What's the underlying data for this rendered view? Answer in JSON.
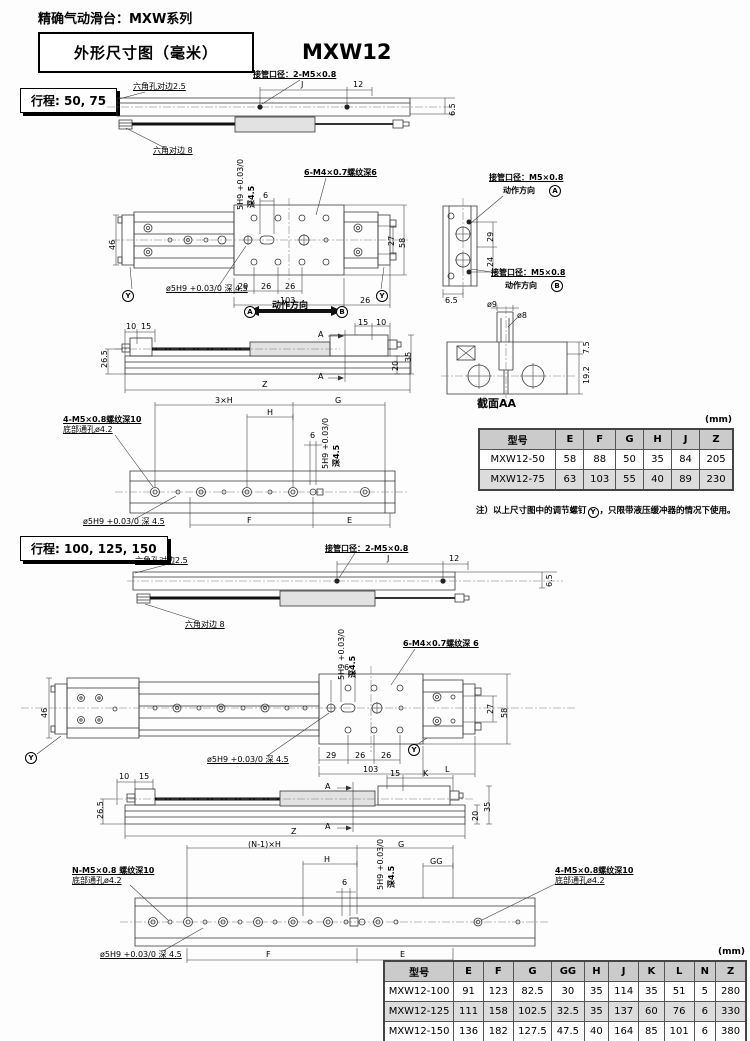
{
  "page": {
    "title": "精确气动滑台：MXW系列",
    "dim_box": "外形尺寸图（毫米）",
    "model": "MXW12"
  },
  "s1": {
    "stroke_label": "行程: 50, 75",
    "sv": {
      "hex_hole": "六角孔对边2.5",
      "port": "接管口径：2-M5×0.8",
      "j": "J",
      "d12": "12",
      "d65": "6.5",
      "hex_flat": "六角对边 8"
    },
    "tv": {
      "pin_tol": "5H9 +0.03/0",
      "pin_depth": "深4.5",
      "d6": "6",
      "thread": "6-M4×0.7螺纹深6",
      "d46": "46",
      "d27": "27",
      "d58": "58",
      "pin_hole": "ø5H9 +0.03/0 深 4.5",
      "d29": "29",
      "d26a": "26",
      "d26b": "26",
      "d103": "103",
      "d26c": "26",
      "y": "Y",
      "dir_label": "动作方向",
      "a": "A",
      "b": "B"
    },
    "fv": {
      "d10": "10",
      "d15": "15",
      "a": "A",
      "d15r": "15",
      "d10r": "10",
      "d20": "20",
      "d35": "35",
      "d265": "26.5",
      "z": "Z"
    },
    "bv": {
      "d3xh": "3×H",
      "g": "G",
      "h": "H",
      "d6": "6",
      "pin_tol": "5H9 +0.03/0",
      "pin_depth": "深4.5",
      "thread1": "4-M5×0.8螺纹深10",
      "thread2": "底部通孔ø4.2",
      "pin_hole": "ø5H9 +0.03/0 深 4.5",
      "f": "F",
      "e": "E"
    },
    "ev": {
      "port_a": "接管口径：M5×0.8",
      "dir_a": "动作方向",
      "a": "A",
      "d29": "29",
      "d24": "24",
      "port_b": "接管口径：M5×0.8",
      "dir_b": "动作方向",
      "b": "B",
      "d65": "6.5"
    },
    "aa": {
      "d9": "ø9",
      "d8": "ø8",
      "d75": "7.5",
      "d192": "19.2",
      "label": "截面AA"
    },
    "table": {
      "unit": "(mm)",
      "headers": [
        "型号",
        "E",
        "F",
        "G",
        "H",
        "J",
        "Z"
      ],
      "rows": [
        [
          "MXW12-50",
          "58",
          "88",
          "50",
          "35",
          "84",
          "205"
        ],
        [
          "MXW12-75",
          "63",
          "103",
          "55",
          "40",
          "89",
          "230"
        ]
      ],
      "note_pre": "注）以上尺寸图中的调节螺钉",
      "note_y": "Y",
      "note_post": "，只限带液压缓冲器的情况下使用。"
    }
  },
  "s2": {
    "stroke_label": "行程: 100, 125, 150",
    "sv": {
      "hex_hole": "六角孔对边2.5",
      "port": "接管口径：2-M5×0.8",
      "j": "J",
      "d12": "12",
      "d65": "6.5",
      "hex_flat": "六角对边 8"
    },
    "tv": {
      "pin_tol": "5H9 +0.03/0",
      "pin_depth": "深4.5",
      "d6": "6",
      "thread": "6-M4×0.7螺纹深 6",
      "d46": "46",
      "d27": "27",
      "d58": "58",
      "pin_hole": "ø5H9 +0.03/0 深 4.5",
      "d29": "29",
      "d26a": "26",
      "d26b": "26",
      "d103": "103",
      "l": "L",
      "y": "Y"
    },
    "fv": {
      "d10": "10",
      "d15": "15",
      "a": "A",
      "d15r": "15",
      "k": "K",
      "d20": "20",
      "d35": "35",
      "d265": "26.5",
      "z": "Z"
    },
    "bv": {
      "n1xh": "(N-1)×H",
      "g": "G",
      "h": "H",
      "d6": "6",
      "pin_tol": "5H9 +0.03/0",
      "pin_depth": "深4.5",
      "gg": "GG",
      "thread_n1": "N-M5×0.8 螺纹深10",
      "thread_n2": "底部通孔ø4.2",
      "thread_41": "4-M5×0.8螺纹深10",
      "thread_42": "底部通孔ø4.2",
      "pin_hole": "ø5H9 +0.03/0 深 4.5",
      "f": "F",
      "e": "E"
    },
    "table": {
      "unit": "(mm)",
      "headers": [
        "型号",
        "E",
        "F",
        "G",
        "GG",
        "H",
        "J",
        "K",
        "L",
        "N",
        "Z"
      ],
      "rows": [
        [
          "MXW12-100",
          "91",
          "123",
          "82.5",
          "30",
          "35",
          "114",
          "35",
          "51",
          "5",
          "280"
        ],
        [
          "MXW12-125",
          "111",
          "158",
          "102.5",
          "32.5",
          "35",
          "137",
          "60",
          "76",
          "6",
          "330"
        ],
        [
          "MXW12-150",
          "136",
          "182",
          "127.5",
          "47.5",
          "40",
          "164",
          "85",
          "101",
          "6",
          "380"
        ]
      ]
    }
  }
}
